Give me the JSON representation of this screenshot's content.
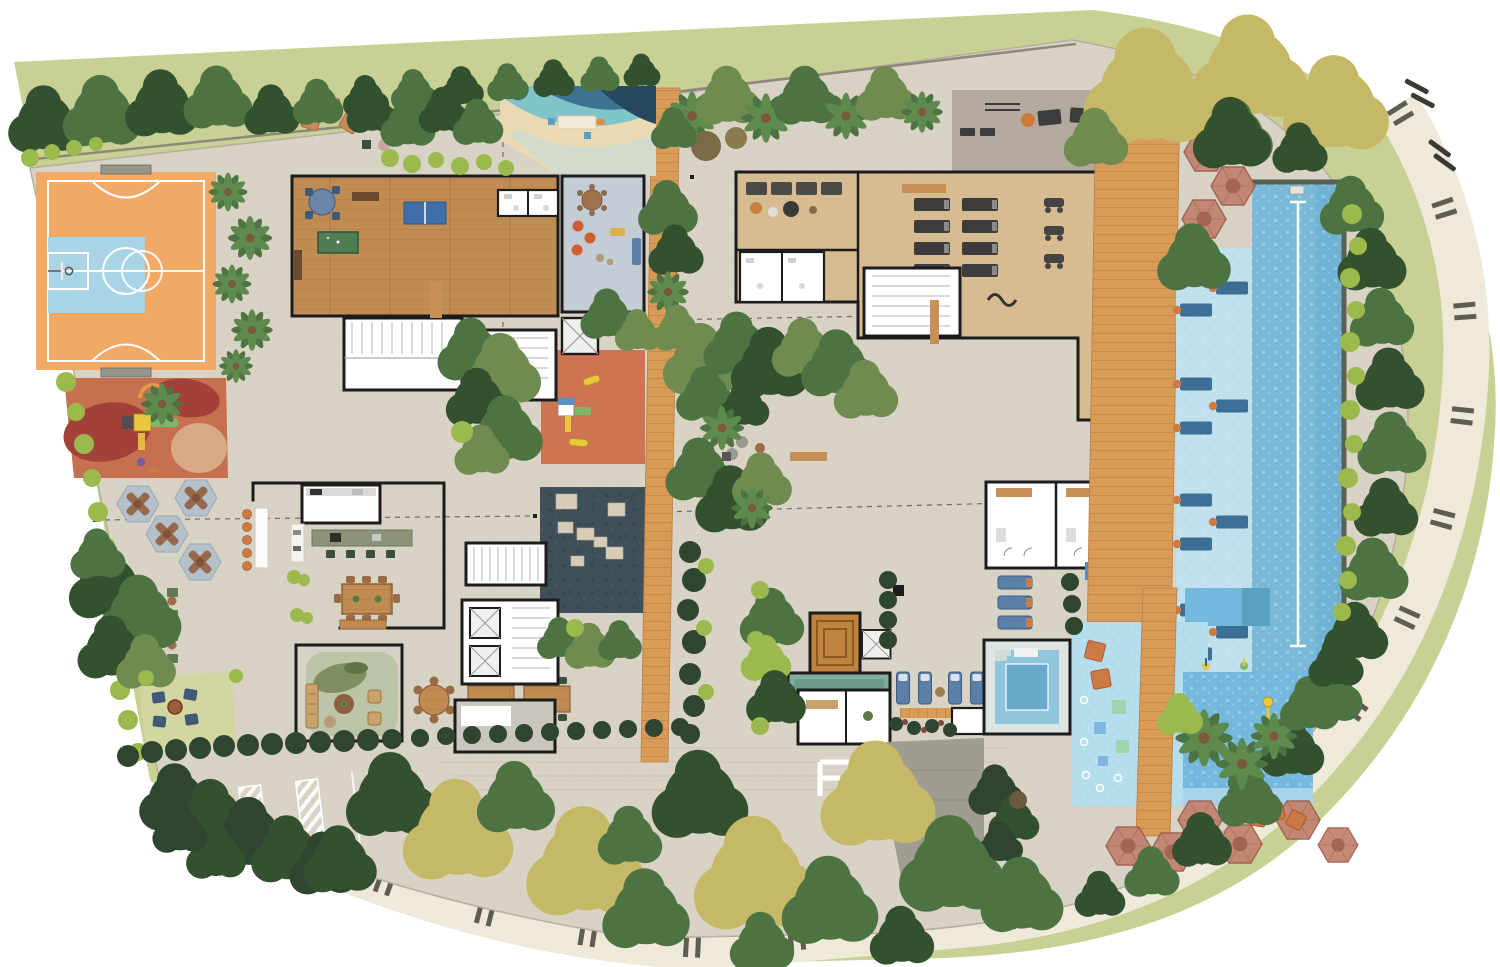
{
  "meta": {
    "title": "Residential condominium ground-floor implantation plan (top view)",
    "type": "architectural site plan rendering",
    "width_px": 1500,
    "height_px": 967,
    "visible_text": "none"
  },
  "areas": [
    {
      "id": "sports-court",
      "label": "Multi-sport court (futsal + basketball half court)"
    },
    {
      "id": "kids-playground",
      "label": "Kids playground with rubber floor and play tower"
    },
    {
      "id": "picnic-grove",
      "label": "Picnic grove with hexagonal game tables"
    },
    {
      "id": "garden-benches",
      "label": "Garden bench alley"
    },
    {
      "id": "fire-pit-lawn",
      "label": "Fire pit lounge on lawn"
    },
    {
      "id": "games-lounge",
      "label": "Games lounge with pool table and ping-pong"
    },
    {
      "id": "kids-beach-pool",
      "label": "Kids beach-entry leisure pool"
    },
    {
      "id": "kids-playroom",
      "label": "Kids playroom"
    },
    {
      "id": "restrooms",
      "label": "Restrooms"
    },
    {
      "id": "outdoor-lounge-terrace",
      "label": "Outdoor lounge terrace with floor cushions"
    },
    {
      "id": "gourmet-kitchen",
      "label": "Gourmet kitchen"
    },
    {
      "id": "bar-counters",
      "label": "Outdoor bar counters with stools"
    },
    {
      "id": "dining-hall",
      "label": "Dining hall with long table"
    },
    {
      "id": "living-lounge",
      "label": "Living lounge with rug and sofas"
    },
    {
      "id": "reflecting-pool",
      "label": "Dark reflecting pool with stepping stones"
    },
    {
      "id": "central-playground",
      "label": "Central courtyard playground"
    },
    {
      "id": "timber-boardwalk",
      "label": "Central timber boardwalk"
    },
    {
      "id": "courtyard-gardens",
      "label": "Courtyard garden beds"
    },
    {
      "id": "fitness-center",
      "label": "Fitness center with treadmills and bikes"
    },
    {
      "id": "relax-room",
      "label": "Relax / massage room"
    },
    {
      "id": "outdoor-gym-terrace",
      "label": "Outdoor gym terrace"
    },
    {
      "id": "stair-cores",
      "label": "Stair and elevator cores"
    },
    {
      "id": "locker-rooms",
      "label": "Locker / changing rooms with showers"
    },
    {
      "id": "sauna",
      "label": "Sauna with stepped timber benches"
    },
    {
      "id": "steam-room",
      "label": "Steam room"
    },
    {
      "id": "whirlpool-spa",
      "label": "Whirlpool spa"
    },
    {
      "id": "spa-loungers",
      "label": "Spa loungers"
    },
    {
      "id": "lap-pool",
      "label": "Lap pool with swim lane"
    },
    {
      "id": "wet-deck-loungers",
      "label": "Wet-deck submerged loungers"
    },
    {
      "id": "pool-timber-deck",
      "label": "Pool timber deck"
    },
    {
      "id": "pool-umbrellas",
      "label": "Pool umbrellas"
    },
    {
      "id": "splash-pad",
      "label": "Kids splash pad"
    },
    {
      "id": "kids-pool",
      "label": "Kids pool with water toy"
    },
    {
      "id": "timber-bridge",
      "label": "Timber bridge over kids pool area"
    },
    {
      "id": "umbrella-lounge",
      "label": "Umbrella lounge with cushions"
    },
    {
      "id": "entrance-lobby",
      "label": "Entrance lobby"
    },
    {
      "id": "driveway-ramp",
      "label": "Driveway / garage ramp"
    },
    {
      "id": "accessible-parking",
      "label": "Accessible parking stalls"
    },
    {
      "id": "perimeter-sidewalk",
      "label": "Perimeter sidewalk with tactile paving"
    },
    {
      "id": "street-lawn",
      "label": "Street lawn verge"
    },
    {
      "id": "tree-rows",
      "label": "Perimeter tree rows"
    },
    {
      "id": "crosswalk",
      "label": "Street crosswalk stripes"
    }
  ],
  "icons": [
    {
      "id": "wheelchair-icon",
      "label": "Accessible parking wheelchair symbol"
    },
    {
      "id": "umbrella-icon",
      "label": "Hexagonal parasol"
    },
    {
      "id": "tree-icon",
      "label": "Tree canopy"
    },
    {
      "id": "palm-icon",
      "label": "Palm tree"
    },
    {
      "id": "lounger-icon",
      "label": "Sun lounger"
    },
    {
      "id": "picnic-table-icon",
      "label": "Hexagonal picnic table"
    }
  ],
  "colors": {
    "bg": "#ffffff",
    "lawn": "#c9d093",
    "sidewalk": "#efe9da",
    "tactile": "#45433a",
    "paving": "#d9d3c5",
    "paving-line": "#c7c0ae",
    "wall": "#1c1c1c",
    "room": "#ffffff",
    "room-gray": "#e8e7e3",
    "wall-line": "#8d887b",
    "court-orange": "#f1a966",
    "court-blue": "#a9d4e5",
    "court-line": "#ffffff",
    "play-base": "#c7704f",
    "play-dark": "#a14137",
    "play-tan": "#d9a884",
    "toy-yellow": "#e9c83e",
    "toy-green": "#7cb968",
    "toy-blue": "#5b8fc9",
    "toy-purple": "#7a5aa0",
    "picnic-hex": "#b3c1cb",
    "picnic-table": "#96684c",
    "lawn-patch": "#d4d6a2",
    "chair-navy": "#3e5a74",
    "bench-green": "#5d7a50",
    "wood-floor": "#c18c53",
    "wood-line": "#a9743f",
    "timber": "#d89c58",
    "timber-line": "#bc7e3e",
    "pool-table": "#4e7d52",
    "pingpong": "#3f6fa8",
    "beach-sand": "#ead9b3",
    "beach-teal": "#7fc4c9",
    "beach-mid": "#3d7291",
    "beach-navy": "#27485f",
    "playroom": "#c4cdd5",
    "pouf-orange": "#cf5f33",
    "sofa-blue": "#5b7fa6",
    "gym-floor": "#d8bc91",
    "equip-dark": "#3c3c3c",
    "terrace-gray": "#b3aa9d",
    "sauna-wood": "#c08440",
    "steam-teal": "#7fae9f",
    "jacuzzi": "#8fc6dc",
    "jacuzzi-deep": "#67a9c9",
    "pool": "#7ab8d7",
    "pool-dark": "#68aed1",
    "wet-deck": "#c0e0ec",
    "sub-lounger": "#3d6f96",
    "pool-edge": "#5c6051",
    "lane": "#ffffff",
    "mirror": "#3f505b",
    "stone": "#d7ccb5",
    "splash": "#b4ddee",
    "kids-pool": "#74b8dd",
    "aqua-green": "#9fd6b0",
    "aqua-blue": "#7fb7e0",
    "umbrella": "#c2826f",
    "umbrella-dark": "#9f5f4e",
    "cushion": "#cd7a45",
    "tree-green": "#4d7342",
    "tree-olive": "#6f8b50",
    "tree-dark": "#33502f",
    "tree-yellow": "#c5b967",
    "shrub-lime": "#9cb94e",
    "hedge-dark": "#2e4530",
    "drive-gray": "#a09c92",
    "paint-white": "#ffffff"
  }
}
